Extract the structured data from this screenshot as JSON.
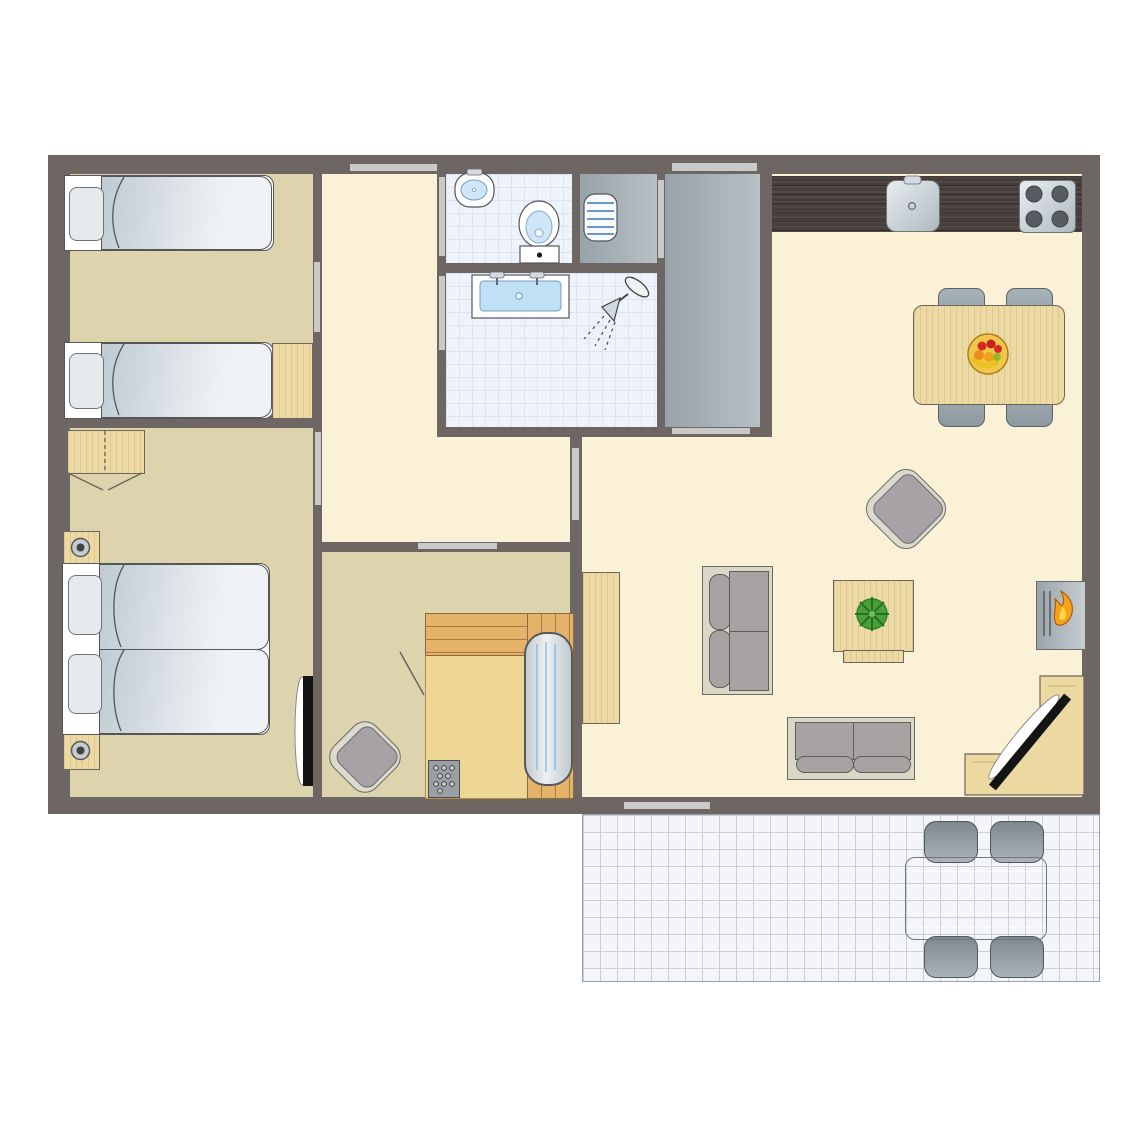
{
  "palette": {
    "bg": "#ffffff",
    "wall": "#6e6662",
    "floor-cream": "#faf1d6",
    "floor-tan": "#ddd3ac",
    "floor-tile": "#eef2fa",
    "tile-line": "#dde4f1",
    "floor-gray-a": "#97a2a9",
    "floor-gray-b": "#b7c0c4",
    "terrace": "#f4f5f8",
    "terrace-line": "#c9ced8",
    "door-bar": "#c9c9c7",
    "wood": "#ecd9a3",
    "wood-dark": "#453e3a",
    "sauna-wood": "#e5b26a",
    "sauna-floor": "#eed795",
    "sofa-frame": "#d9d8c6",
    "cushion": "#a8a3a3",
    "mattress-a": "#bfcad2",
    "mattress-b": "#eff2f4",
    "basin-blue": "#bfe0f5",
    "flame-orange": "#f6a21b",
    "flame-yellow": "#ffd94a",
    "plant-green": "#46a238",
    "heater-line-blue": "#6c96c6"
  },
  "floorplan": {
    "rooms": [
      {
        "id": "bedroom-1",
        "furniture": [
          "single-bed",
          "single-bed",
          "nightstand"
        ]
      },
      {
        "id": "bedroom-2",
        "furniture": [
          "double-bed",
          "wardrobe",
          "nightstand",
          "nightstand",
          "wall-tv"
        ]
      },
      {
        "id": "hallway",
        "furniture": []
      },
      {
        "id": "toilet-room",
        "furniture": [
          "corner-sink",
          "toilet"
        ]
      },
      {
        "id": "utility-room",
        "furniture": [
          "radiator"
        ]
      },
      {
        "id": "bathroom",
        "furniture": [
          "double-sink-vanity",
          "corner-shower"
        ]
      },
      {
        "id": "entrance-hall",
        "furniture": []
      },
      {
        "id": "living-kitchen",
        "furniture": [
          "kitchen-counter",
          "kitchen-sink",
          "cooktop",
          "dining-table",
          "dining-chair",
          "dining-chair",
          "dining-chair",
          "dining-chair",
          "fruit-bowl",
          "armchair",
          "two-seat-sofa",
          "coffee-table",
          "potted-plant",
          "sideboard",
          "fireplace",
          "loveseat",
          "corner-tv-unit",
          "flatscreen-tv"
        ]
      },
      {
        "id": "sauna-room",
        "furniture": [
          "armchair",
          "sauna-bench",
          "sauna-lounger",
          "sauna-heater"
        ]
      },
      {
        "id": "terrace",
        "furniture": [
          "outdoor-table",
          "outdoor-chair",
          "outdoor-chair",
          "outdoor-chair",
          "outdoor-chair"
        ]
      }
    ],
    "openings": {
      "windows": [
        "hallway-top-window"
      ],
      "exterior_doors": [
        "entrance-door",
        "terrace-door"
      ],
      "interior_doorways": [
        "bedroom-1-doorway",
        "bedroom-2-doorway",
        "toilet-doorway",
        "bathroom-doorway",
        "utility-doorway",
        "entrance-hall-doorway",
        "sauna-room-doorway",
        "living-room-doorway"
      ]
    }
  }
}
